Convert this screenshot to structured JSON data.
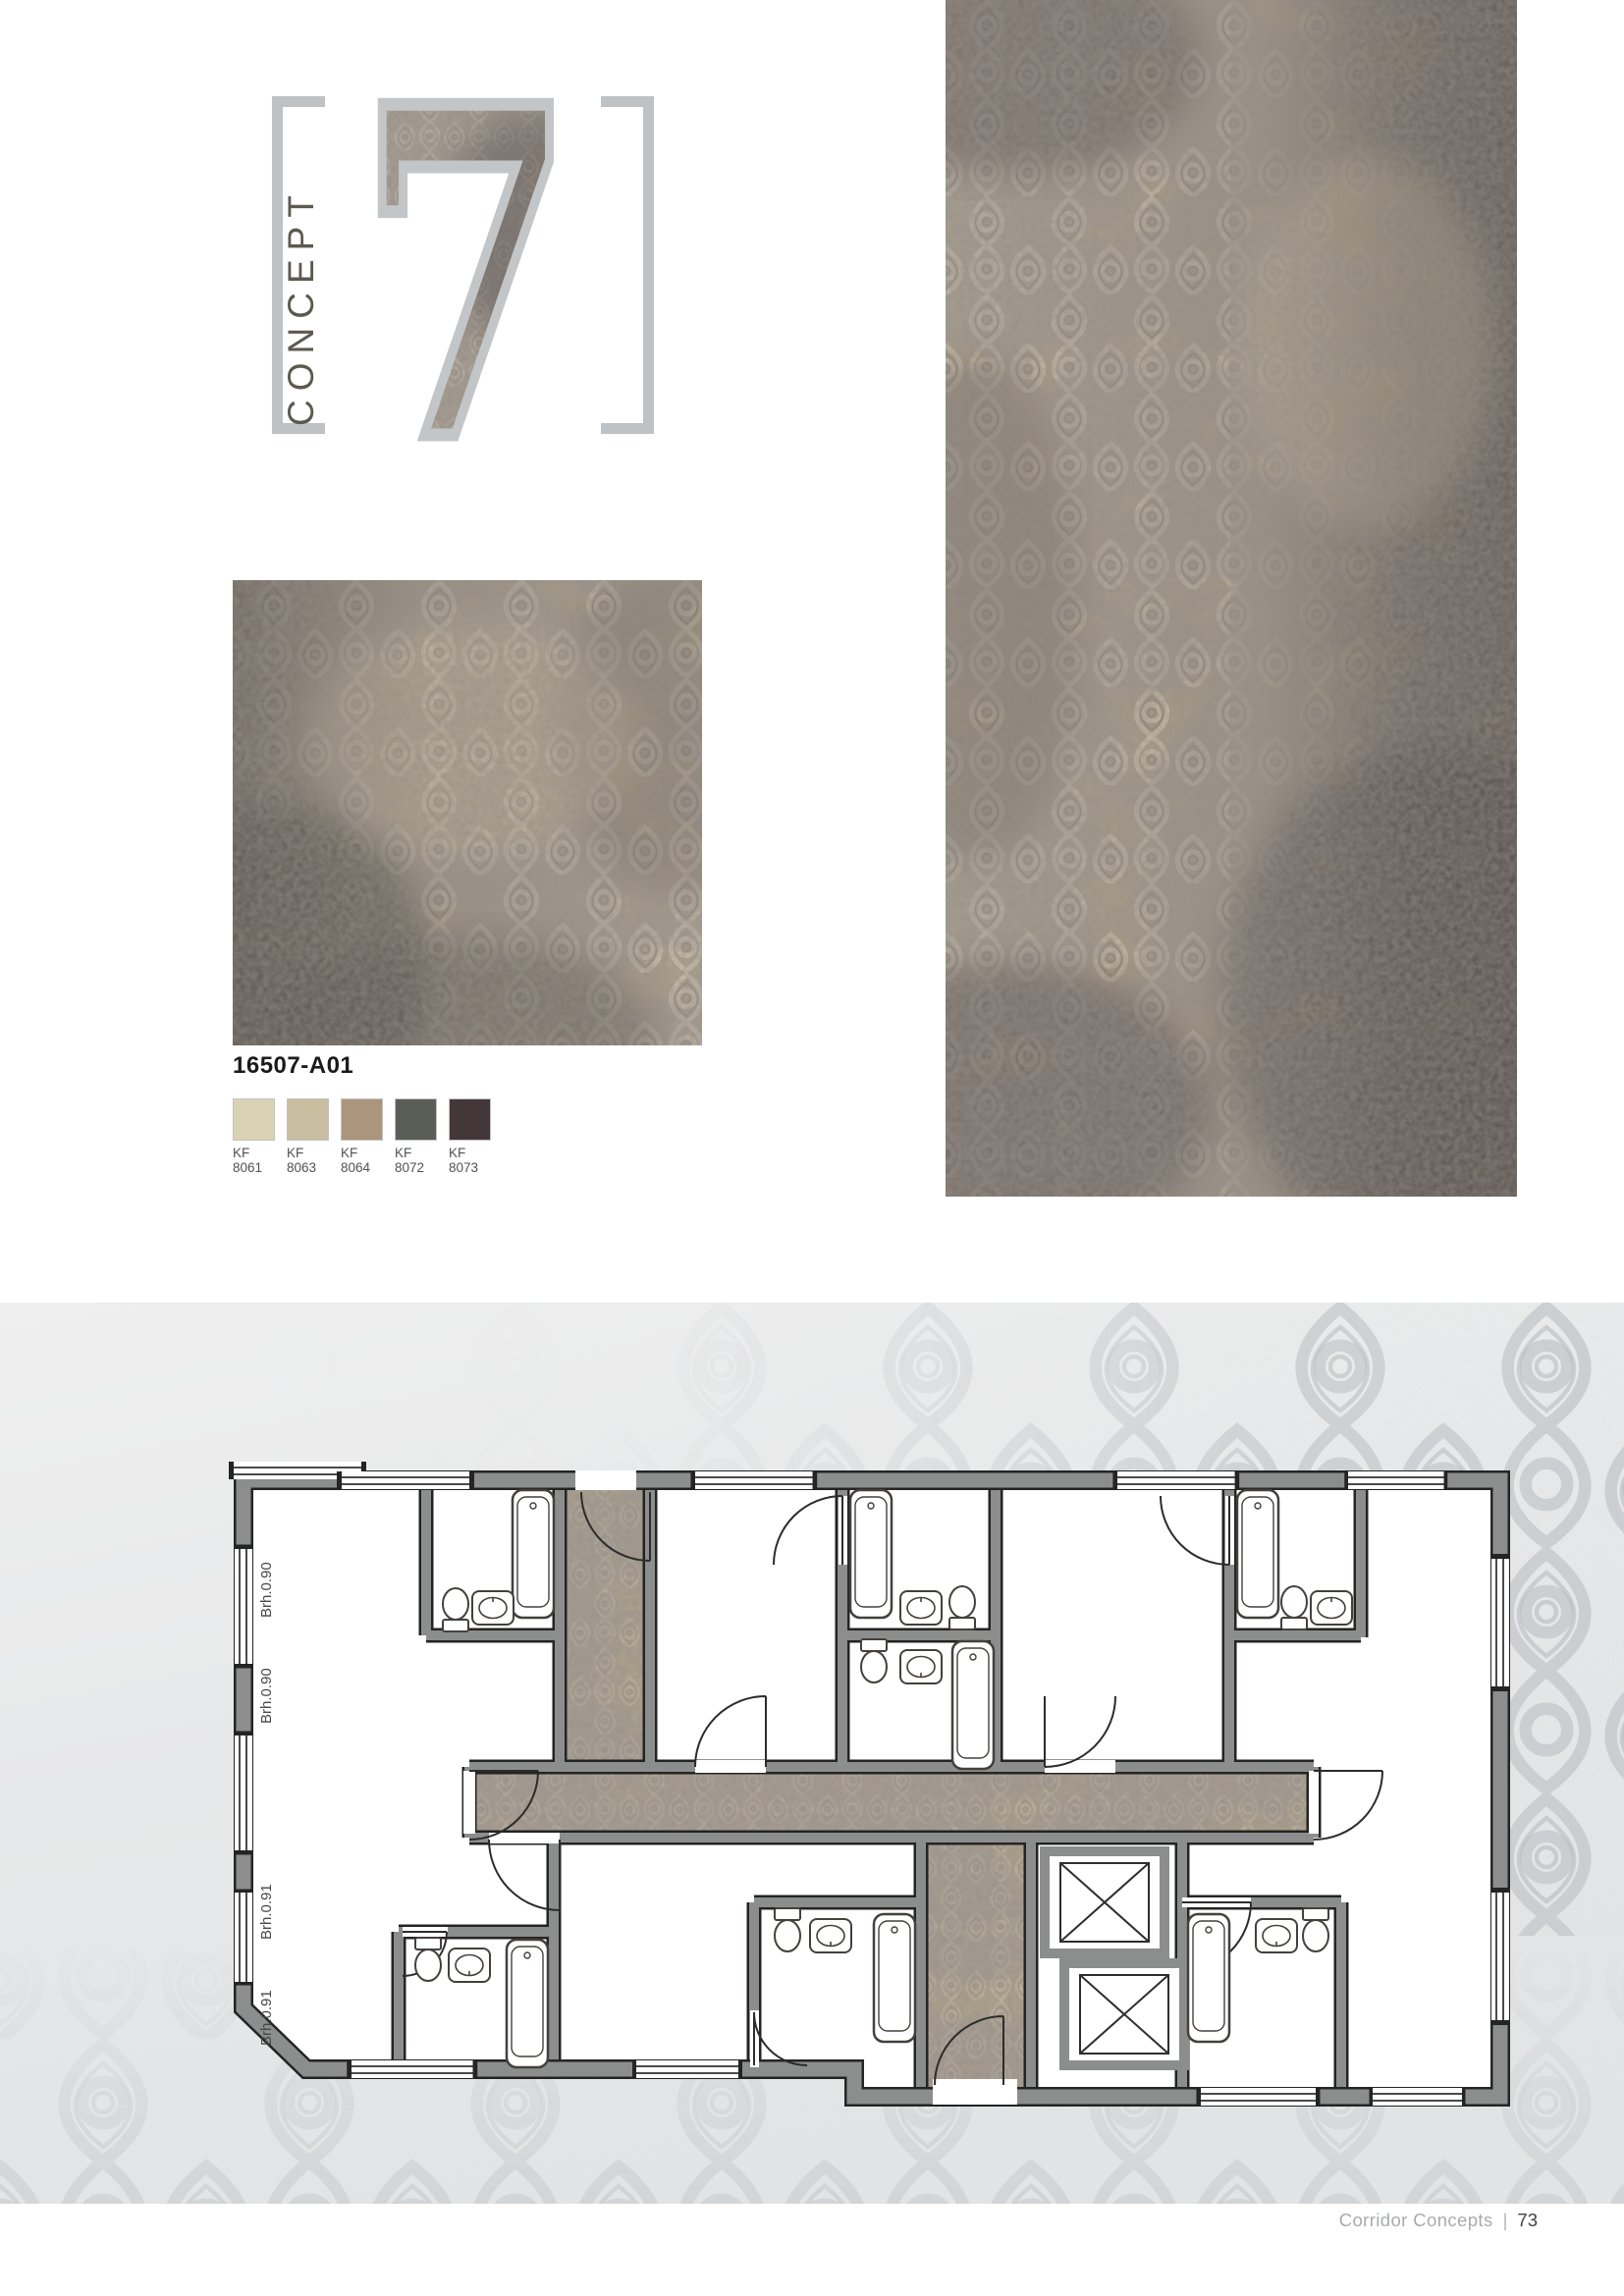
{
  "logo": {
    "label": "CONCEPT",
    "number": "7"
  },
  "product": {
    "code": "16507-A01"
  },
  "swatches": [
    {
      "line1": "KF",
      "line2": "8061",
      "color": "#d9d2b5"
    },
    {
      "line1": "KF",
      "line2": "8063",
      "color": "#c9bda0"
    },
    {
      "line1": "KF",
      "line2": "8064",
      "color": "#ab957d"
    },
    {
      "line1": "KF",
      "line2": "8072",
      "color": "#5b5d57"
    },
    {
      "line1": "KF",
      "line2": "8073",
      "color": "#44373a"
    }
  ],
  "floor_plan": {
    "labels": [
      "Brh.0.90",
      "Brh.0.90",
      "Brh.0.91",
      "Brh.0.91"
    ]
  },
  "footer": {
    "title": "Corridor Concepts",
    "separator": "|",
    "page": "73"
  },
  "colors": {
    "carpet_base": "#b3a589",
    "carpet_motif_light": "#ddd3b6",
    "carpet_wash_dark": "#5b534f",
    "panel_bg": "#e7e8e9",
    "panel_motif": "#c3c7ca",
    "wall_grey": "#8b8e8c",
    "bracket_grey": "#bec2c4"
  }
}
